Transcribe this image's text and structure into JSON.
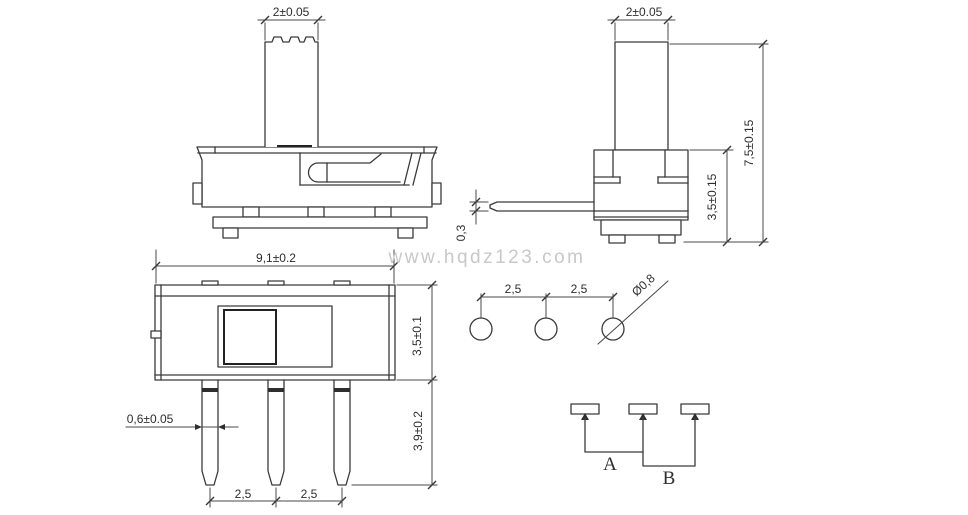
{
  "title": "slide-switch-technical-drawing",
  "watermark": "www.hqdz123.com",
  "front_view": {
    "knob_width": "2±0.05"
  },
  "side_view": {
    "knob_width": "2±0.05",
    "terminal_thickness": "0,3",
    "body_height": "3,5±0.15",
    "total_height": "7,5±0.15"
  },
  "top_view": {
    "body_length": "9,1±0.2",
    "body_width": "3,5±0.1",
    "terminal_width": "0,6±0.05",
    "terminal_length": "3,9±0.2",
    "pitch_left": "2,5",
    "pitch_right": "2,5"
  },
  "hole_layout": {
    "pitch_left": "2,5",
    "pitch_right": "2,5",
    "hole_diameter": "Ø0,8"
  },
  "schematic": {
    "position_a": "A",
    "position_b": "B"
  },
  "colors": {
    "line": "#3a3a3a",
    "dimension": "#4a4a4a",
    "watermark": "#c8c8c8",
    "background": "#ffffff"
  }
}
